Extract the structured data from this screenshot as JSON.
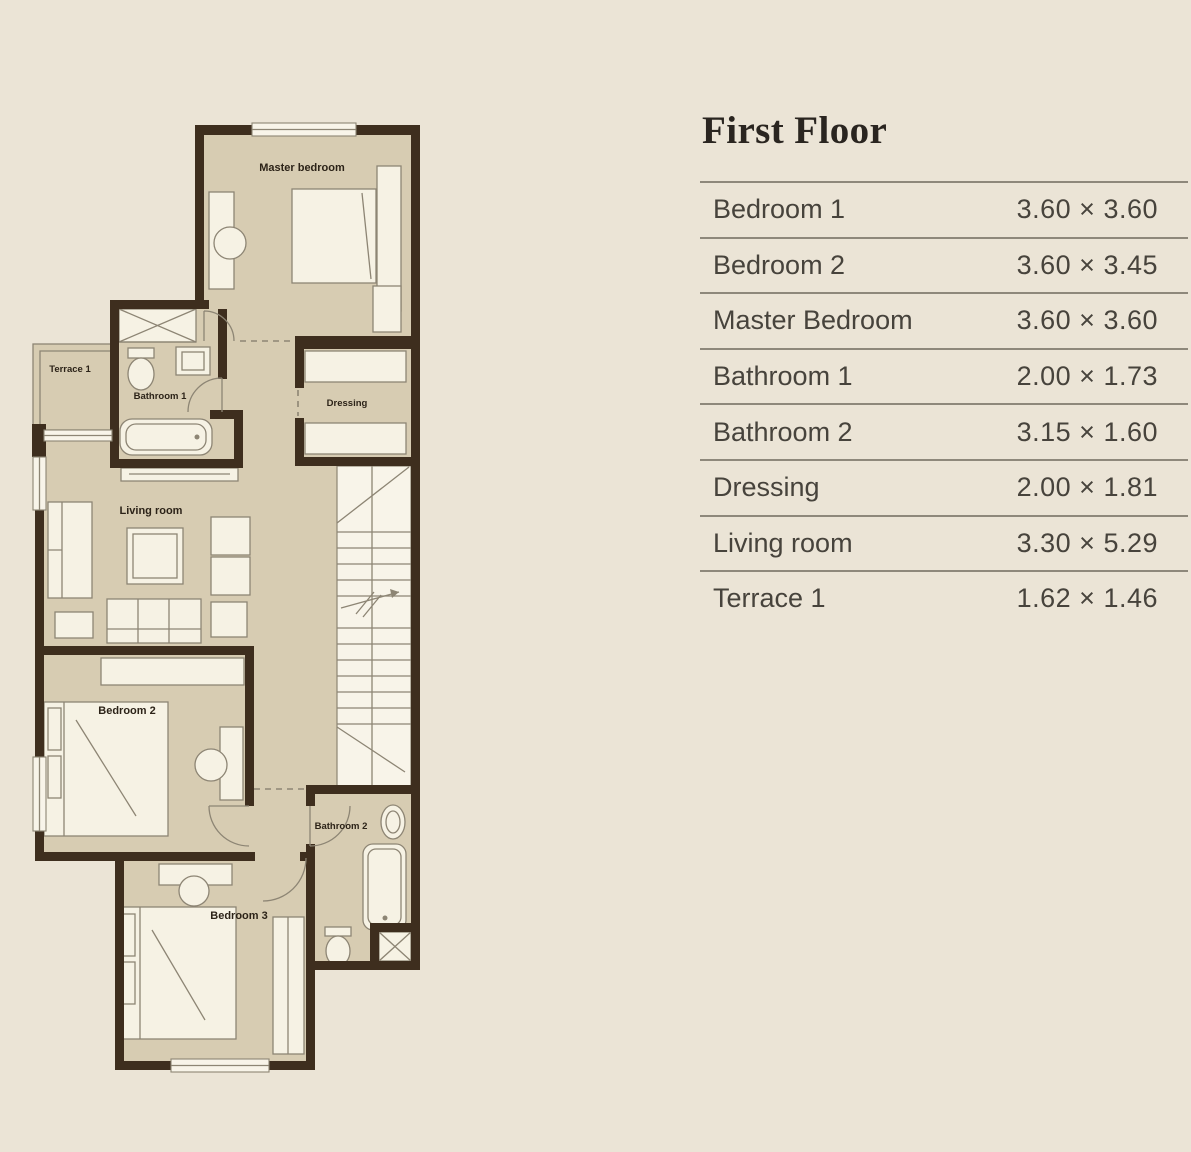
{
  "colors": {
    "bg": "#ebe4d6",
    "wall": "#3e2e1e",
    "room": "#d7ccb2",
    "furn": "#f6f2e4",
    "win": "#f8f4e9",
    "line": "#8d8574",
    "ink": "#2c2318",
    "text": "#47433c",
    "rule": "#8e887b",
    "title": "#2a2520"
  },
  "panel": {
    "title": "First Floor",
    "rows": [
      {
        "label": "Bedroom 1",
        "size": "3.60 × 3.60"
      },
      {
        "label": "Bedroom 2",
        "size": "3.60 × 3.45"
      },
      {
        "label": "Master Bedroom",
        "size": "3.60 × 3.60"
      },
      {
        "label": "Bathroom 1",
        "size": "2.00 × 1.73"
      },
      {
        "label": "Bathroom 2",
        "size": "3.15 × 1.60"
      },
      {
        "label": "Dressing",
        "size": "2.00 × 1.81"
      },
      {
        "label": "Living room",
        "size": "3.30 × 5.29"
      },
      {
        "label": "Terrace 1",
        "size": "1.62 × 1.46"
      }
    ]
  },
  "floorplan": {
    "labels": {
      "master_bedroom": "Master bedroom",
      "terrace": "Terrace 1",
      "bathroom1": "Bathroom 1",
      "dressing": "Dressing",
      "living_room": "Living room",
      "bedroom2": "Bedroom 2",
      "bathroom2": "Bathroom 2",
      "bedroom3": "Bedroom 3"
    }
  }
}
